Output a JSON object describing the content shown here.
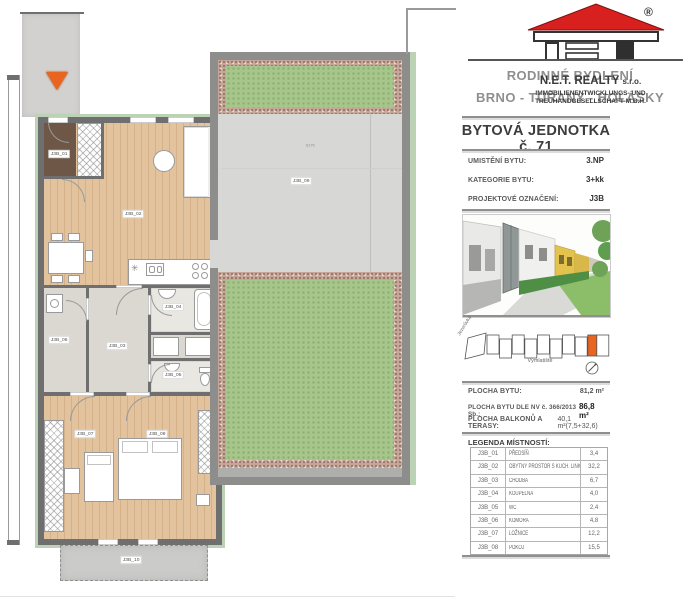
{
  "panel": {
    "logo": {
      "registered": "®",
      "project_line1": "RODINNÉ BYDLENÍ",
      "project_line2": "BRNO - TUŘANY - HOLÁSKY",
      "company_name": "N.E.T. REALTY",
      "company_suffix": "s.r.o.",
      "company_line2": "IMMOBILIENENTWICKLUNGS- UND",
      "company_line3": "TREUHANDGESELLSCHAFT M.B.H."
    },
    "title": "BYTOVÁ JEDNOTKA č. 71",
    "details": [
      {
        "label": "UMISTĚNÍ BYTU:",
        "value": "3.NP"
      },
      {
        "label": "KATEGORIE BYTU:",
        "value": "3+kk"
      },
      {
        "label": "PROJEKTOVÉ OZNAČENÍ:",
        "value": "J3B"
      }
    ],
    "site": {
      "street_diagonal": "Jezerůvka",
      "street_bottom": "Výmlatiště"
    },
    "areas": [
      {
        "label": "PLOCHA BYTU:",
        "value": "81,2 m²"
      },
      {
        "label": "PLOCHA BYTU DLE NV č. 366/2013 Sb.:",
        "value": "86,8 m²"
      },
      {
        "label": "PLOCHA BALKONŮ A TERASY:",
        "value": "40,1 m²(7,5+32,6)"
      }
    ],
    "legend": {
      "title": "LEGENDA MÍSTNOSTÍ:",
      "rows": [
        {
          "code": "J3B_01",
          "name": "PŘEDSÍŇ",
          "area": "3,4"
        },
        {
          "code": "J3B_02",
          "name": "OBYTNÝ PROSTOR S KUCH. LINKOU",
          "area": "32,2"
        },
        {
          "code": "J3B_03",
          "name": "CHODBA",
          "area": "6,7"
        },
        {
          "code": "J3B_04",
          "name": "KOUPELNA",
          "area": "4,0"
        },
        {
          "code": "J3B_05",
          "name": "WC",
          "area": "2,4"
        },
        {
          "code": "J3B_06",
          "name": "KOMORA",
          "area": "4,8"
        },
        {
          "code": "J3B_07",
          "name": "LOŽNICE",
          "area": "12,2"
        },
        {
          "code": "J3B_08",
          "name": "POKOJ",
          "area": "15,5"
        }
      ]
    }
  },
  "floorplan": {
    "room_labels": {
      "entry": "J3B_01",
      "living": "J3B_02",
      "hall": "J3B_03",
      "bathroom": "J3B_04",
      "wc": "J3B_05",
      "storage": "J3B_06",
      "bedroom": "J3B_07",
      "room2": "J3B_08",
      "terrace": "J3B_09",
      "balcony": "J3B_10"
    },
    "dimensions": {
      "terrace_width": "6175"
    }
  },
  "colors": {
    "accent_orange": "#e8641f",
    "roof_red": "#d8201f",
    "garden_green": "#a6c68c",
    "wall_gray": "#6f6f6f"
  }
}
